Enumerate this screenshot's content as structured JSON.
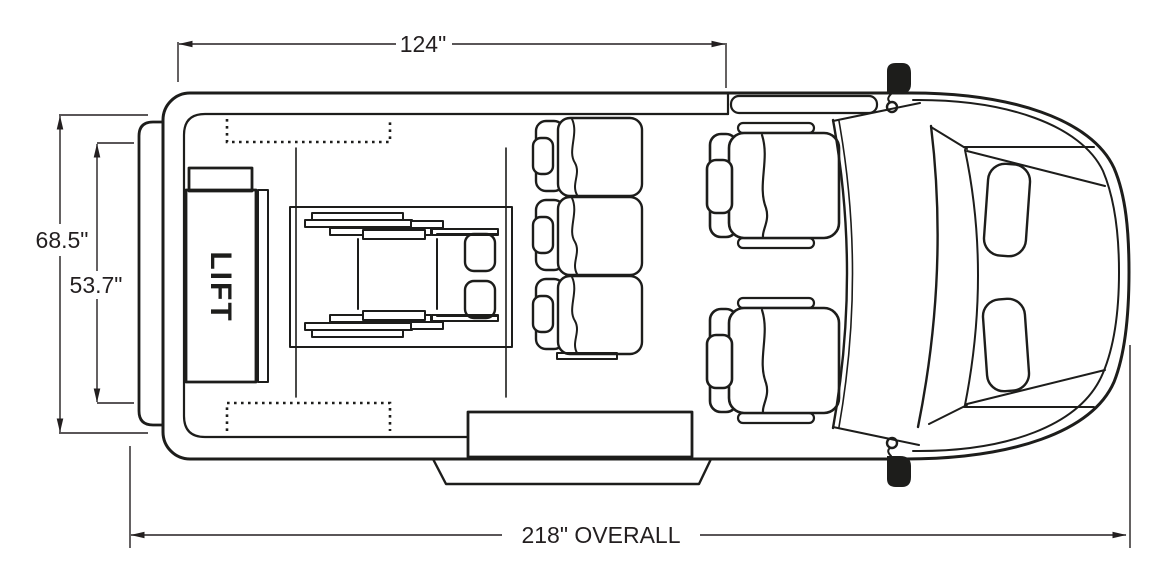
{
  "diagram": {
    "type": "vehicle-floor-plan-top-view",
    "colors": {
      "background": "#ffffff",
      "line": "#1d1d1b",
      "dimension": "#231f20"
    },
    "lift": {
      "label": "LIFT"
    },
    "dimensions": {
      "upper_length": {
        "label": "124\"",
        "value": 124,
        "unit": "inches"
      },
      "overall_width": {
        "label": "68.5\"",
        "value": 68.5,
        "unit": "inches"
      },
      "interior_width": {
        "label": "53.7\"",
        "value": 53.7,
        "unit": "inches"
      },
      "overall_length": {
        "label": "218\" OVERALL",
        "value": 218,
        "unit": "inches"
      }
    }
  }
}
